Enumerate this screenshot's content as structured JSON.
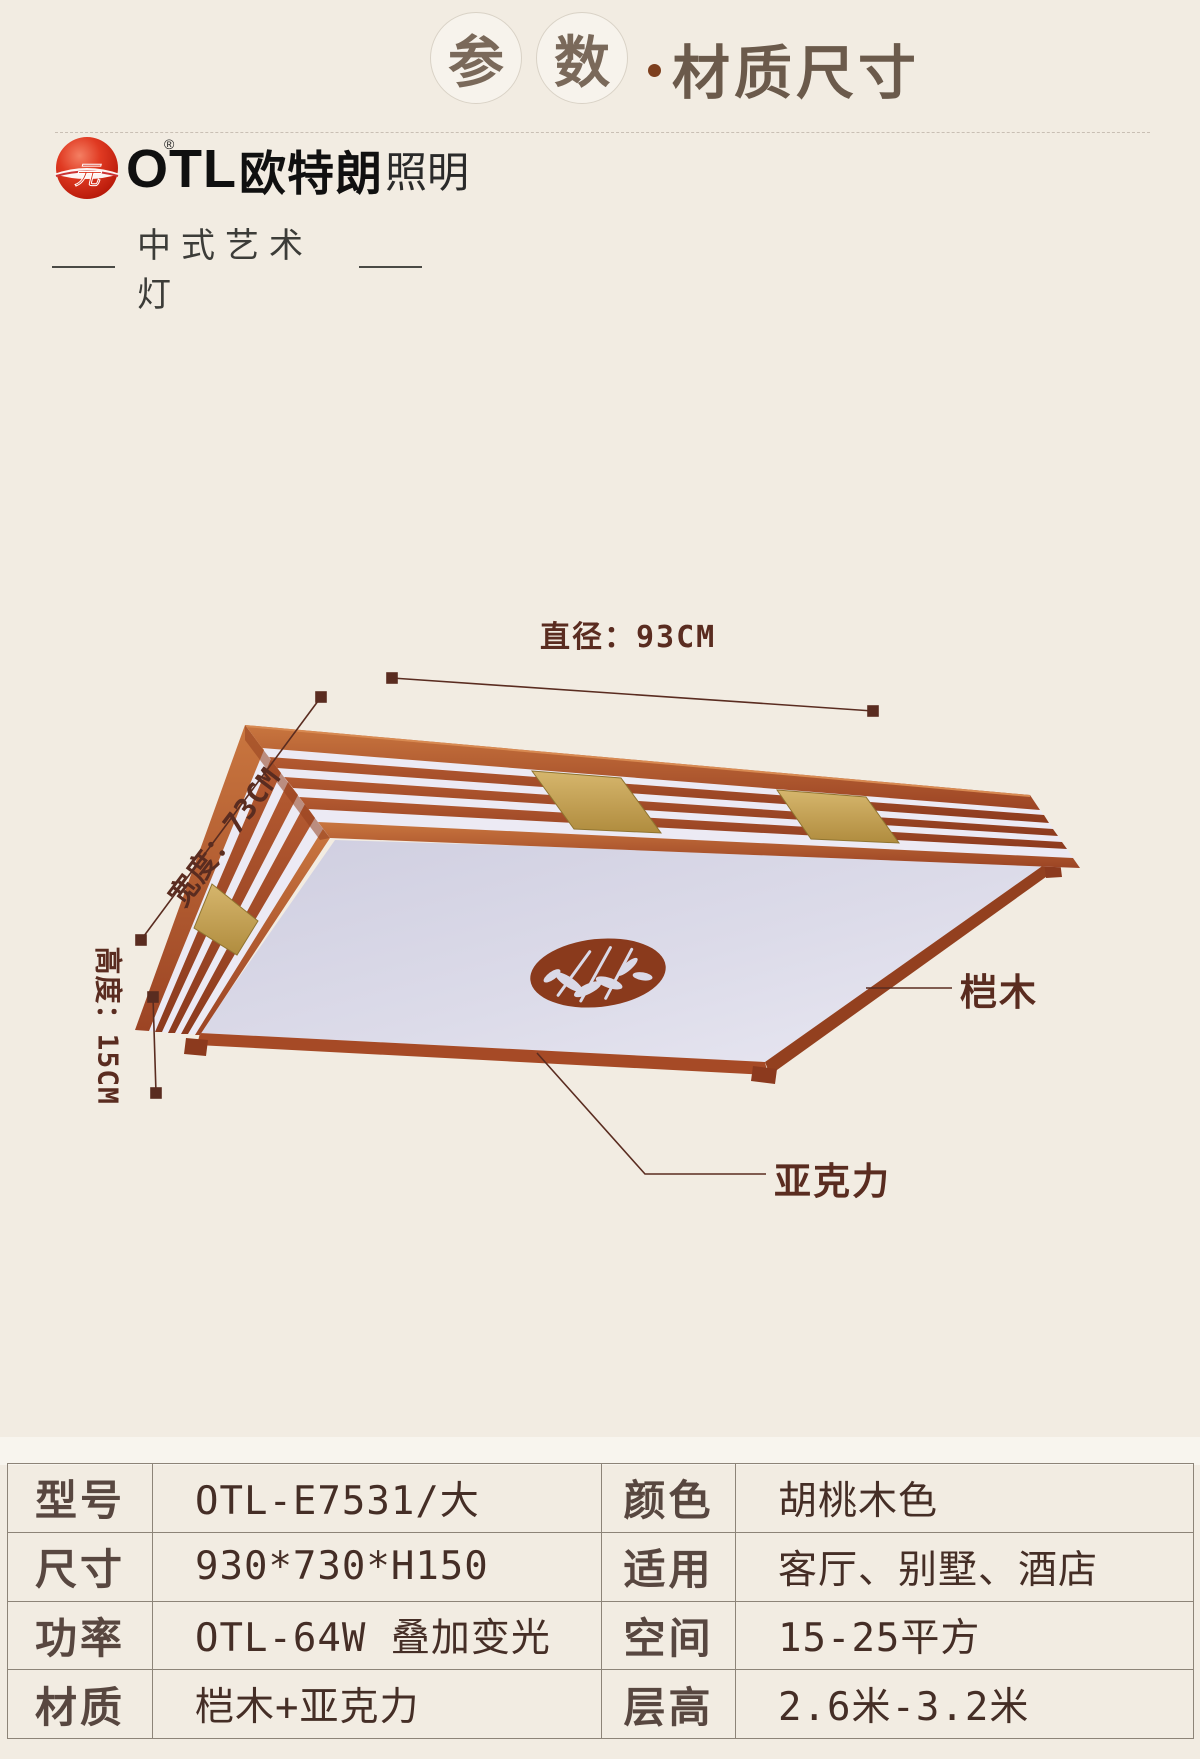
{
  "header": {
    "circle_char_1": "参",
    "circle_char_2": "数",
    "separator_dot": "·",
    "title": "材质尺寸"
  },
  "brand": {
    "mark_char": "元",
    "registered": "®",
    "name_latin": "OTL",
    "name_cn": "欧特朗",
    "name_light": "照明",
    "tagline": "中式艺术灯"
  },
  "figure": {
    "labels": {
      "diameter": "直径：93CM",
      "width": "宽度：73CM",
      "height": "高度：15CM",
      "wood": "桤木",
      "acrylic": "亚克力"
    }
  },
  "spec_table": {
    "rows": [
      {
        "k1": "型号",
        "v1": "OTL-E7531/大",
        "k2": "颜色",
        "v2": "胡桃木色"
      },
      {
        "k1": "尺寸",
        "v1": "930*730*H150",
        "k2": "适用",
        "v2": "客厅、别墅、酒店"
      },
      {
        "k1": "功率",
        "v1": "OTL-64W 叠加变光",
        "k2": "空间",
        "v2": "15-25平方"
      },
      {
        "k1": "材质",
        "v1": "桤木+亚克力",
        "k2": "层高",
        "v2": "2.6米-3.2米"
      }
    ]
  },
  "colors": {
    "page_bg": "#f2ece2",
    "wood": "#b05330",
    "acrylic": "#dad9e7",
    "brass": "#c9a958",
    "medallion": "#8a3a1c",
    "annotation": "#5a2c20"
  }
}
